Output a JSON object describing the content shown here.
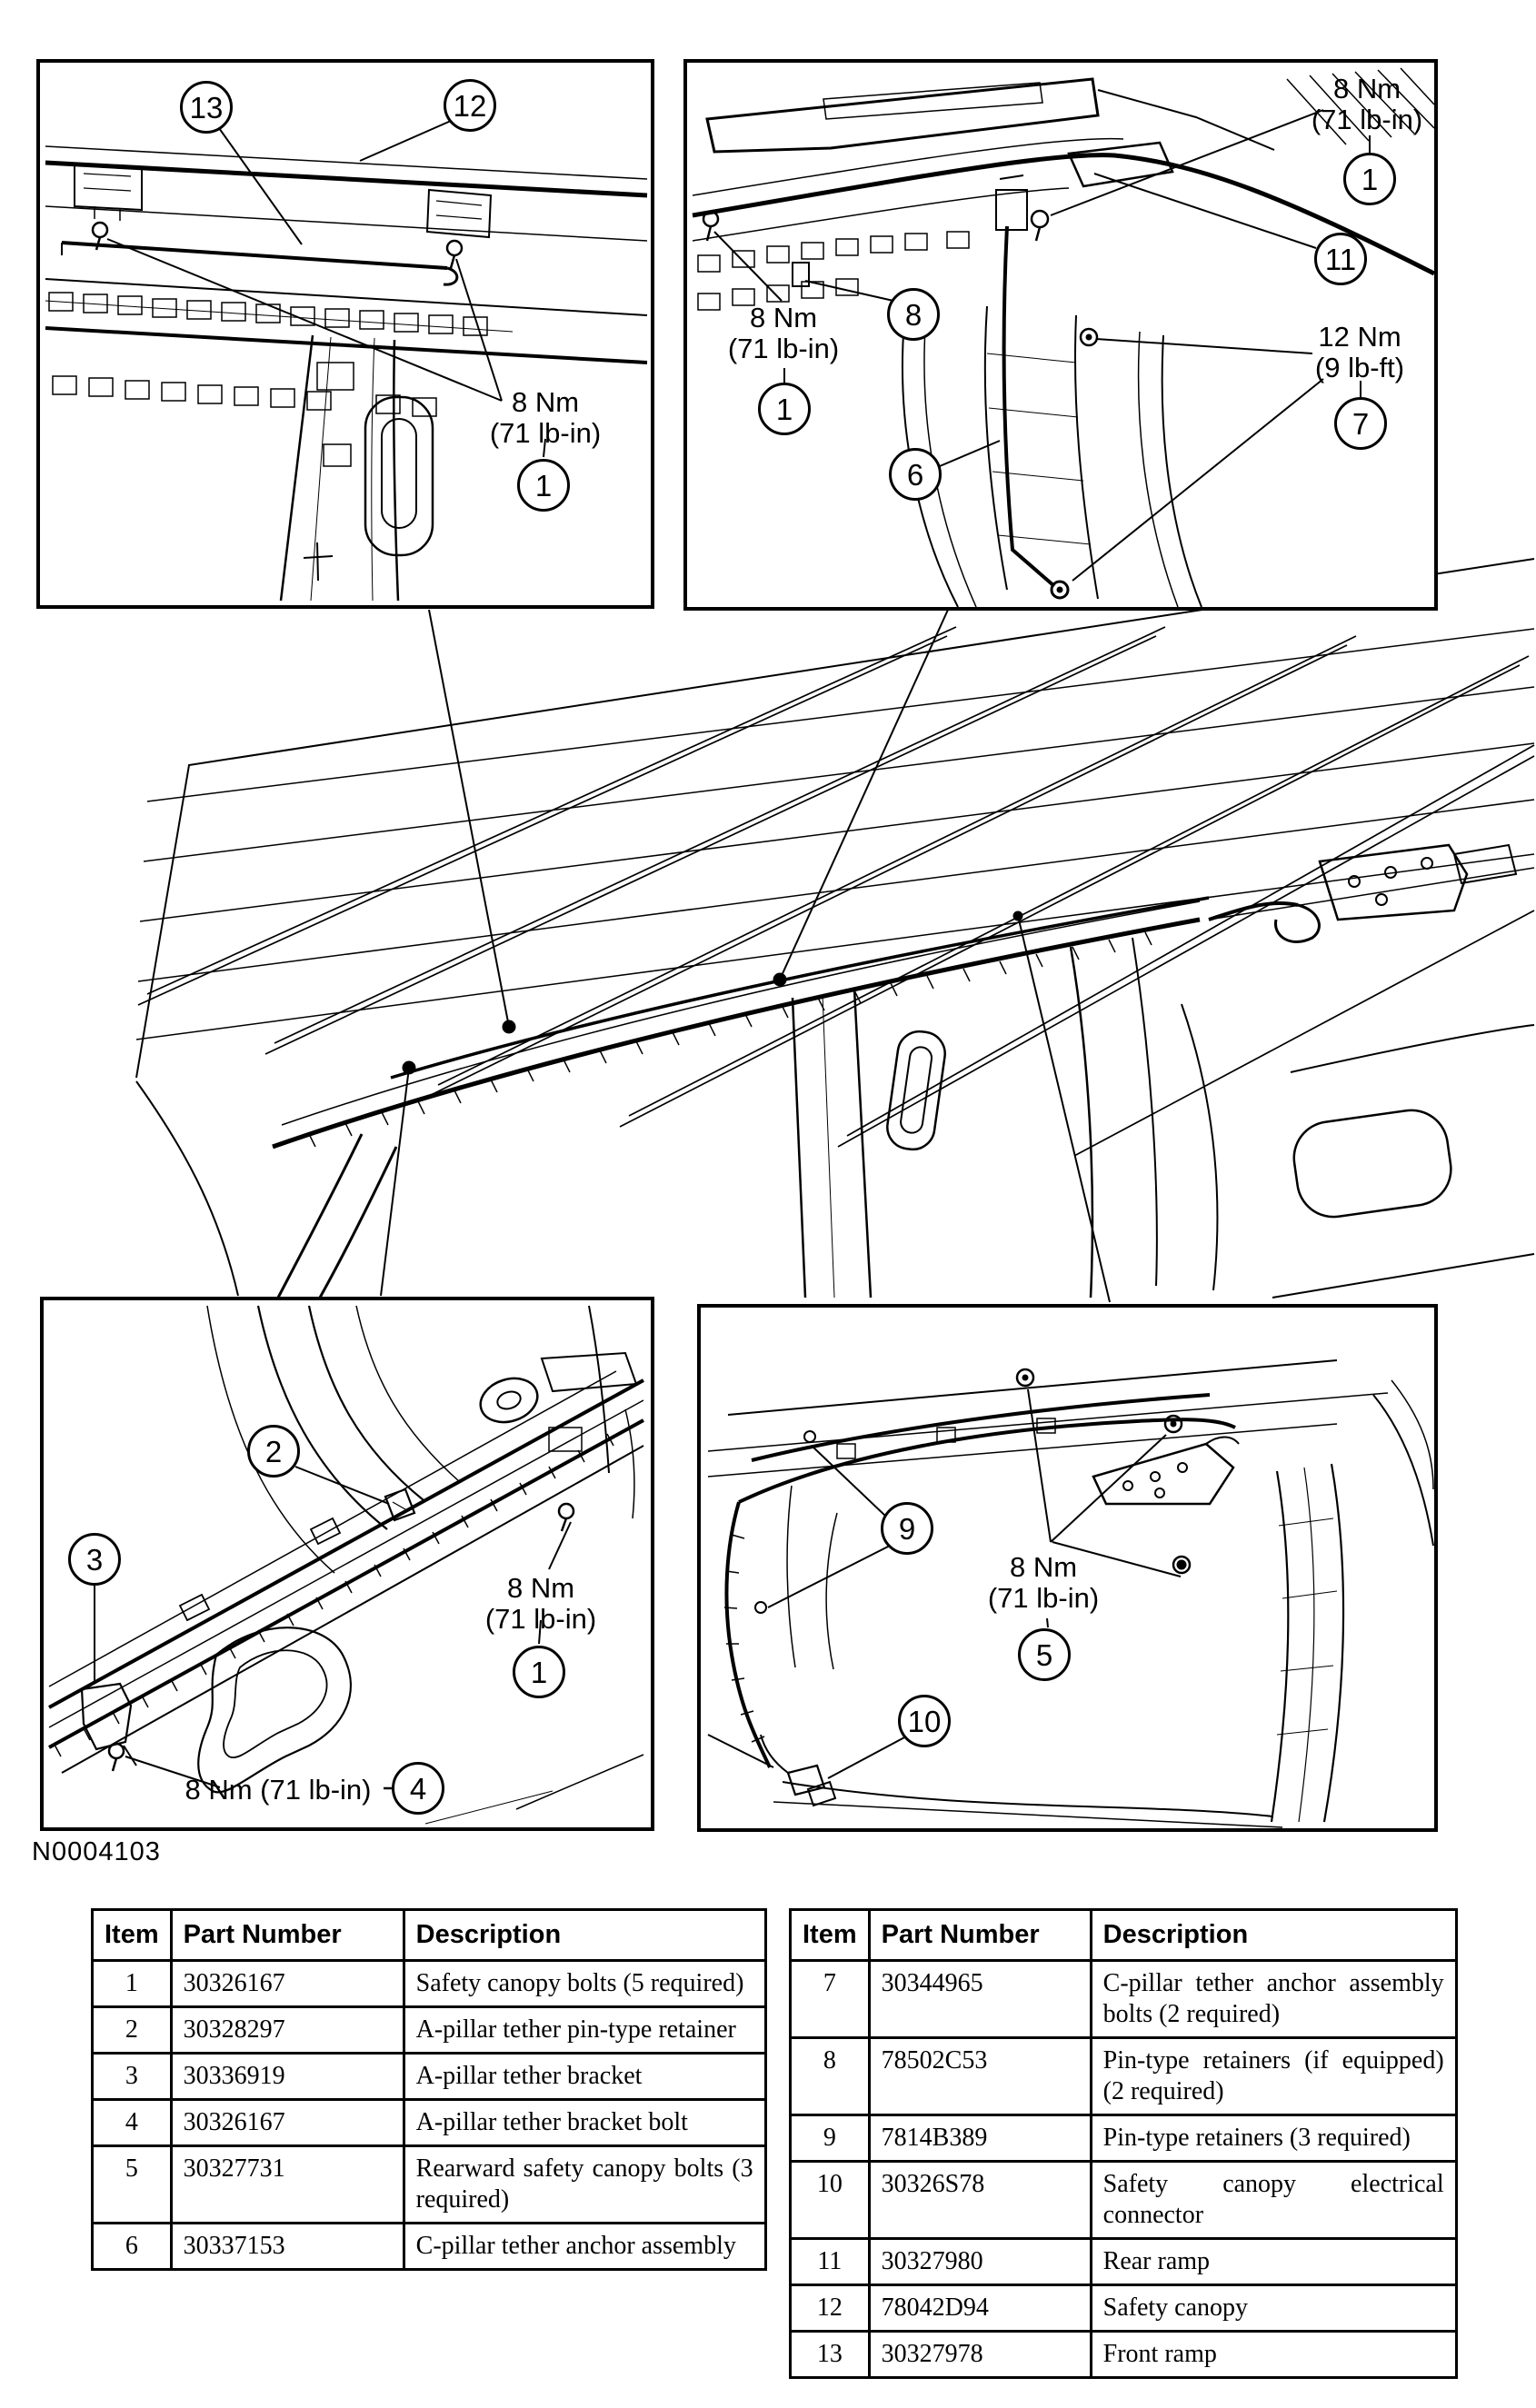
{
  "figure_label": "N0004103",
  "colors": {
    "ink": "#000000",
    "paper": "#ffffff"
  },
  "panels": {
    "top_left": {
      "c13": "13",
      "c12": "12",
      "torque1": {
        "l1": "8 Nm",
        "l2": "(71 lb-in)"
      },
      "c1": "1"
    },
    "top_right": {
      "torque_tr": {
        "l1": "8 Nm",
        "l2": "(71 lb-in)"
      },
      "c1r": "1",
      "c11": "11",
      "torque_left": {
        "l1": "8 Nm",
        "l2": "(71 lb-in)"
      },
      "c1l": "1",
      "c8": "8",
      "c6": "6",
      "torque_12": {
        "l1": "12 Nm",
        "l2": "(9 lb-ft)"
      },
      "c7": "7"
    },
    "bottom_left": {
      "c2": "2",
      "c3": "3",
      "torque1": {
        "l1": "8 Nm",
        "l2": "(71 lb-in)"
      },
      "c1": "1",
      "torque4_text": "8 Nm (71 lb-in)",
      "c4": "4"
    },
    "bottom_right": {
      "c9": "9",
      "torque5": {
        "l1": "8 Nm",
        "l2": "(71 lb-in)"
      },
      "c5": "5",
      "c10": "10"
    }
  },
  "tables": {
    "left": {
      "headers": [
        "Item",
        "Part Number",
        "Description"
      ],
      "rows": [
        [
          "1",
          "30326167",
          "Safety canopy bolts (5 required)"
        ],
        [
          "2",
          "30328297",
          "A-pillar tether pin-type retainer"
        ],
        [
          "3",
          "30336919",
          "A-pillar tether bracket"
        ],
        [
          "4",
          "30326167",
          "A-pillar tether bracket bolt"
        ],
        [
          "5",
          "30327731",
          "Rearward safety canopy bolts (3 required)"
        ],
        [
          "6",
          "30337153",
          "C-pillar tether anchor assembly"
        ]
      ]
    },
    "right": {
      "headers": [
        "Item",
        "Part Number",
        "Description"
      ],
      "rows": [
        [
          "7",
          "30344965",
          "C-pillar tether anchor assembly bolts (2 required)"
        ],
        [
          "8",
          "78502C53",
          "Pin-type retainers (if equipped) (2 required)"
        ],
        [
          "9",
          "7814B389",
          "Pin-type retainers (3 required)"
        ],
        [
          "10",
          "30326S78",
          "Safety canopy electrical connector"
        ],
        [
          "11",
          "30327980",
          "Rear ramp"
        ],
        [
          "12",
          "78042D94",
          "Safety canopy"
        ],
        [
          "13",
          "30327978",
          "Front ramp"
        ]
      ]
    }
  }
}
